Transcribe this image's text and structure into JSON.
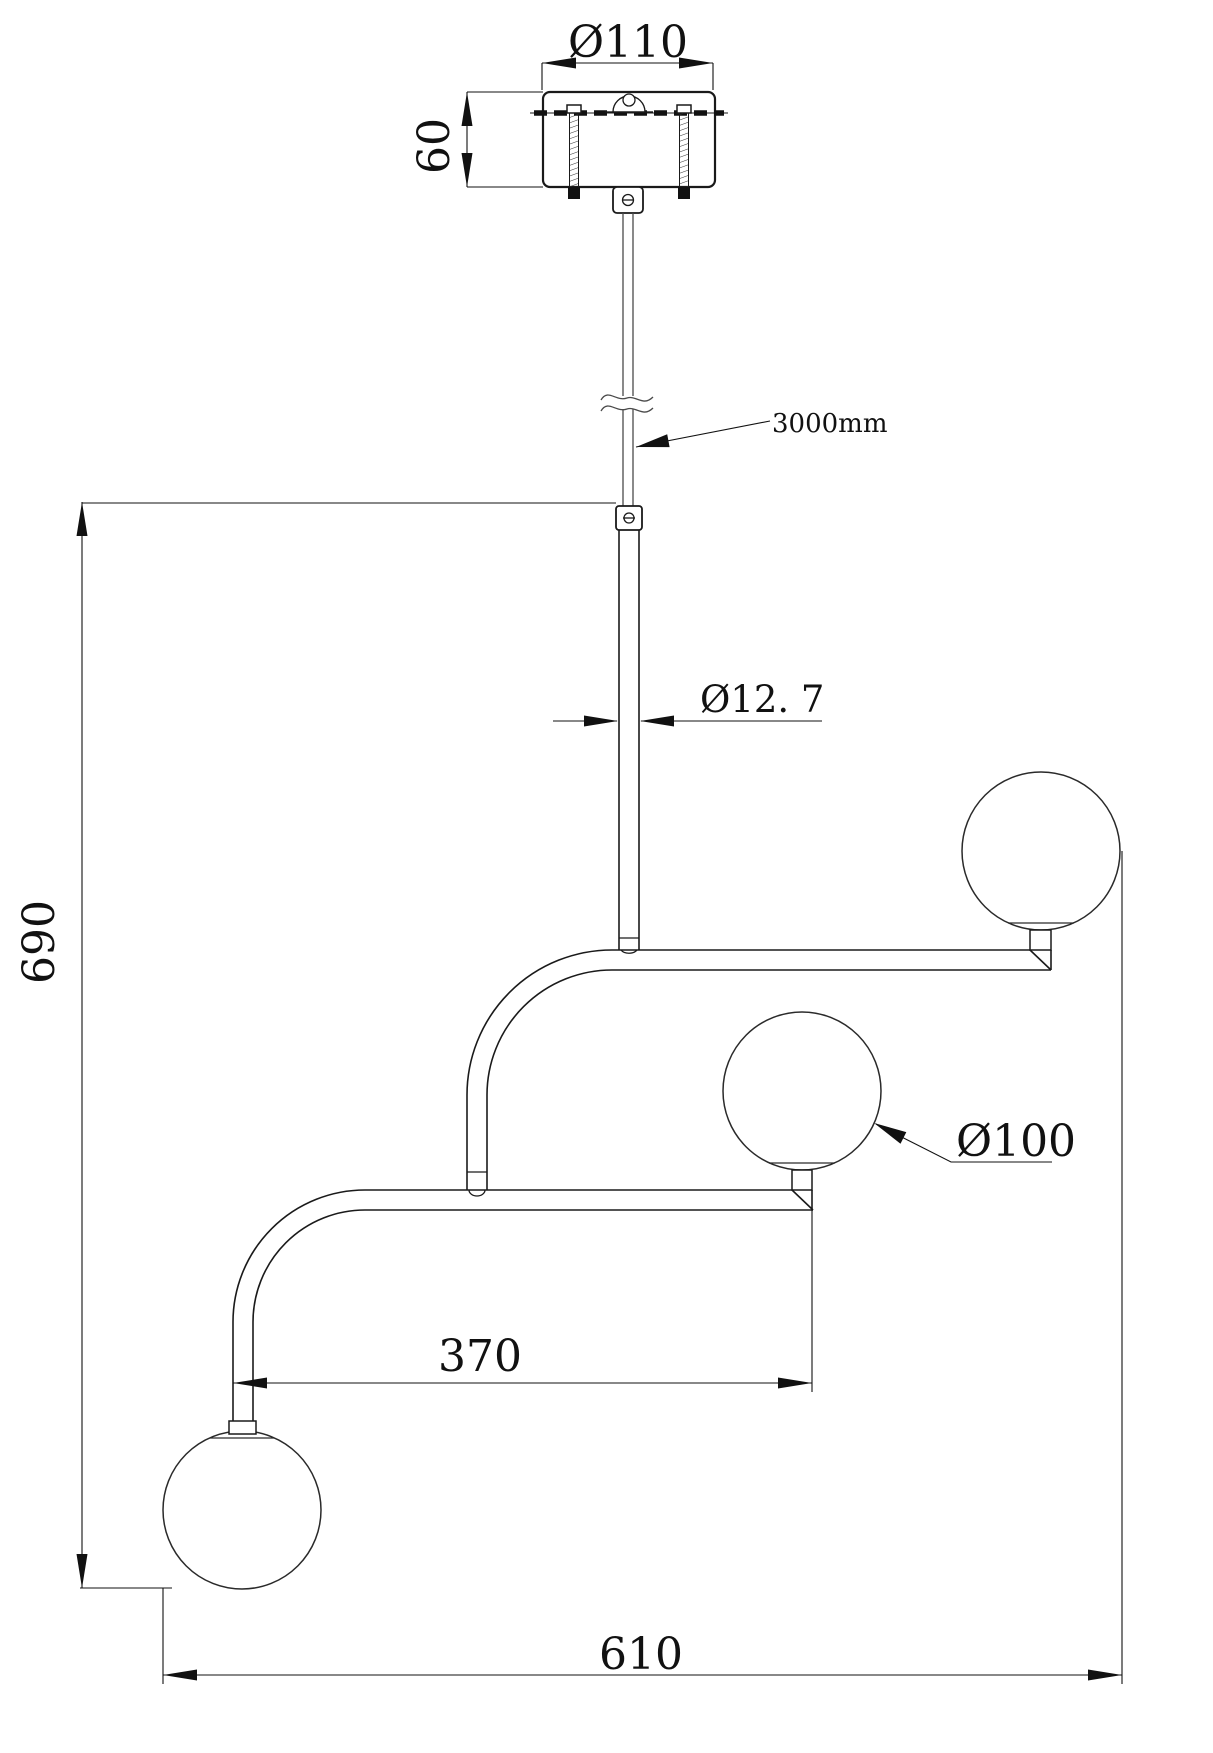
{
  "dims": {
    "canopy_diameter": "Ø110",
    "canopy_height": "60",
    "suspension_length": "3000mm",
    "rod_diameter": "Ø12. 7",
    "fixture_height": "690",
    "globe_diameter": "Ø100",
    "arm_offset": "370",
    "overall_width": "610"
  },
  "colors": {
    "line": "#1a1a1a",
    "dimension": "#111111",
    "background": "#ffffff"
  }
}
